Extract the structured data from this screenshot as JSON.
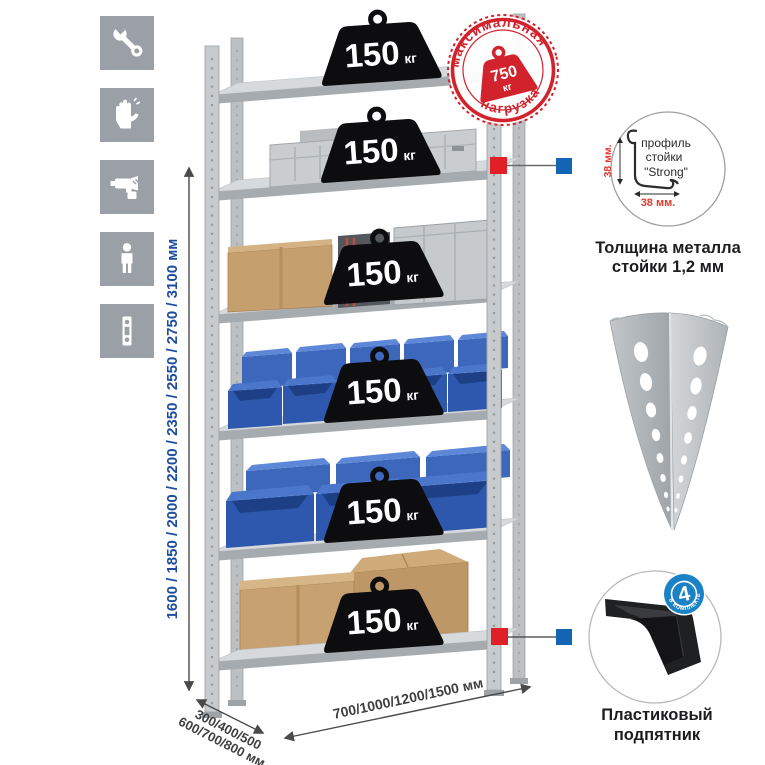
{
  "colors": {
    "accent_red": "#d2232d",
    "accent_blue": "#1465b3",
    "dim_text_blue": "#1c4da1",
    "icon_gray": "#9aa0a5",
    "bin_blue": "#2d58ad",
    "metal_gray": "#c7cbce",
    "cardboard": "#c7a171"
  },
  "icons": [
    {
      "name": "wrench-icon"
    },
    {
      "name": "gloves-icon"
    },
    {
      "name": "drill-icon"
    },
    {
      "name": "person-icon"
    },
    {
      "name": "level-icon"
    }
  ],
  "height_dimension": {
    "label": "1600 / 1850 / 2000 / 2200 / 2350 / 2550 / 2750 / 3100 мм"
  },
  "rack": {
    "shelf_count": 6,
    "shelf_load_value": "150",
    "shelf_load_unit": "кг"
  },
  "max_load_stamp": {
    "arc_top": "максимальная",
    "arc_bottom": "нагрузка",
    "value": "750",
    "unit": "кг"
  },
  "profile_callout": {
    "label_line1": "профиль",
    "label_line2": "стойки",
    "label_line3": "\"Strong\"",
    "height_dim": "38 мм.",
    "width_dim": "38 мм.",
    "caption_line1": "Толщина металла",
    "caption_line2": "стойки 1,2 мм"
  },
  "foot_callout": {
    "badge_count": "4",
    "badge_label": "В КОМПЛЕКТЕ",
    "caption_line1": "Пластиковый",
    "caption_line2": "подпятник"
  },
  "depth_dimension": {
    "line1": "300/400/500",
    "line2": "600/700/800 мм"
  },
  "width_dimension": {
    "label": "700/1000/1200/1500 мм"
  }
}
